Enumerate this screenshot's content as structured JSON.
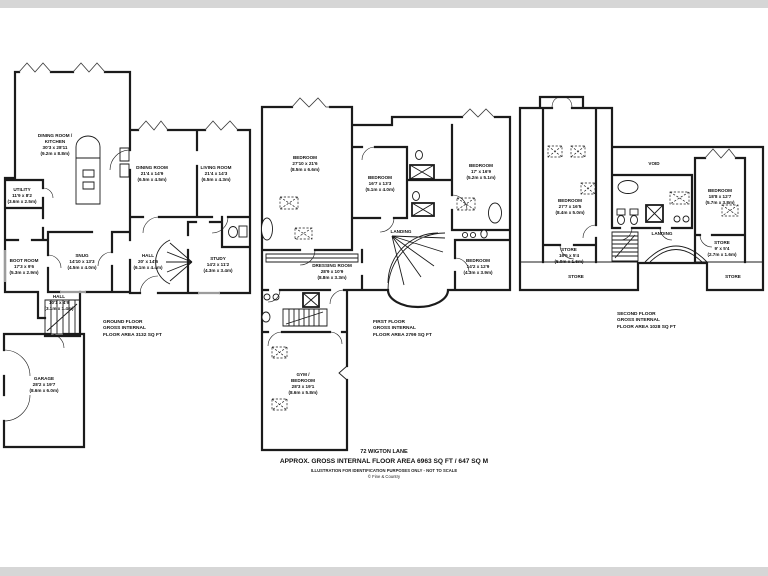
{
  "colors": {
    "wall": "#1b1b1b",
    "window_gray": "#9c9c9c",
    "page_background": "#ffffff",
    "border_band": "#d6d6d6"
  },
  "floors": [
    {
      "caption": {
        "line1": "GROUND FLOOR",
        "line2": "GROSS INTERNAL",
        "line3": "FLOOR AREA 3132 SQ FT"
      },
      "rooms": [
        {
          "name": "DINING ROOM /",
          "name2": "KITCHEN",
          "imperial": "30'3 x 28'11",
          "metric": "(9.2m x 8.8m)"
        },
        {
          "name": "UTILITY",
          "imperial": "11'9 x 8'2",
          "metric": "(3.6m x 2.5m)"
        },
        {
          "name": "DINING ROOM",
          "imperial": "21'4 x 14'9",
          "metric": "(6.5m x 4.5m)"
        },
        {
          "name": "LIVING ROOM",
          "imperial": "21'4 x 14'3",
          "metric": "(6.5m x 4.3m)"
        },
        {
          "name": "BOOT ROOM",
          "imperial": "17'3 x 9'6",
          "metric": "(5.3m x 2.9m)"
        },
        {
          "name": "SNUG",
          "imperial": "14'10 x 13'3",
          "metric": "(4.5m x 4.0m)"
        },
        {
          "name": "HALL",
          "imperial": "20' x 14'6",
          "metric": "(6.1m x 4.4m)"
        },
        {
          "name": "STUDY",
          "imperial": "14'2 x 11'2",
          "metric": "(4.3m x 3.4m)"
        },
        {
          "name": "HALL",
          "imperial": "10'1 x 4'9",
          "metric": "(3.1m x 1.4m)"
        },
        {
          "name": "GARAGE",
          "imperial": "28'2 x 19'7",
          "metric": "(8.6m x 6.0m)"
        }
      ]
    },
    {
      "caption": {
        "line1": "FIRST FLOOR",
        "line2": "GROSS INTERNAL",
        "line3": "FLOOR AREA 2799 SQ FT"
      },
      "rooms": [
        {
          "name": "BEDROOM",
          "imperial": "27'10 x 21'6",
          "metric": "(8.5m x 6.6m)"
        },
        {
          "name": "BEDROOM",
          "imperial": "16'7 x 13'3",
          "metric": "(5.1m x 4.0m)"
        },
        {
          "name": "BEDROOM",
          "imperial": "17' x 16'9",
          "metric": "(5.2m x 5.1m)"
        },
        {
          "name": "LANDING"
        },
        {
          "name": "DRESSING ROOM",
          "imperial": "28'9 x 10'9",
          "metric": "(8.8m x 3.3m)"
        },
        {
          "name": "BEDROOM",
          "imperial": "14'2 x 12'9",
          "metric": "(4.3m x 3.9m)"
        },
        {
          "name": "GYM /",
          "name2": "BEDROOM",
          "imperial": "28'3 x 19'1",
          "metric": "(8.6m x 5.8m)"
        }
      ]
    },
    {
      "caption": {
        "line1": "SECOND FLOOR",
        "line2": "GROSS INTERNAL",
        "line3": "FLOOR AREA 1028 SQ FT"
      },
      "rooms": [
        {
          "name": "BEDROOM",
          "imperial": "27'7 x 16'5",
          "metric": "(8.4m x 5.0m)"
        },
        {
          "name": "VOID"
        },
        {
          "name": "BEDROOM",
          "imperial": "18'8 x 12'7",
          "metric": "(5.7m x 3.8m)"
        },
        {
          "name": "STORE",
          "imperial": "16'5 x 5'4",
          "metric": "(5.0m x 1.6m)"
        },
        {
          "name": "STORE",
          "imperial": "9' x 5'4",
          "metric": "(2.7m x 1.6m)"
        },
        {
          "name": "LANDING"
        },
        {
          "name": "STORE"
        },
        {
          "name": "STORE"
        }
      ]
    }
  ],
  "footer": {
    "address": "72 WIGTON LANE",
    "area": "APPROX. GROSS INTERNAL FLOOR AREA 6963 SQ FT / 647 SQ M",
    "disclaimer": "ILLUSTRATION FOR IDENTIFICATION PURPOSES ONLY - NOT TO SCALE",
    "credit": "© Fine & Country"
  }
}
